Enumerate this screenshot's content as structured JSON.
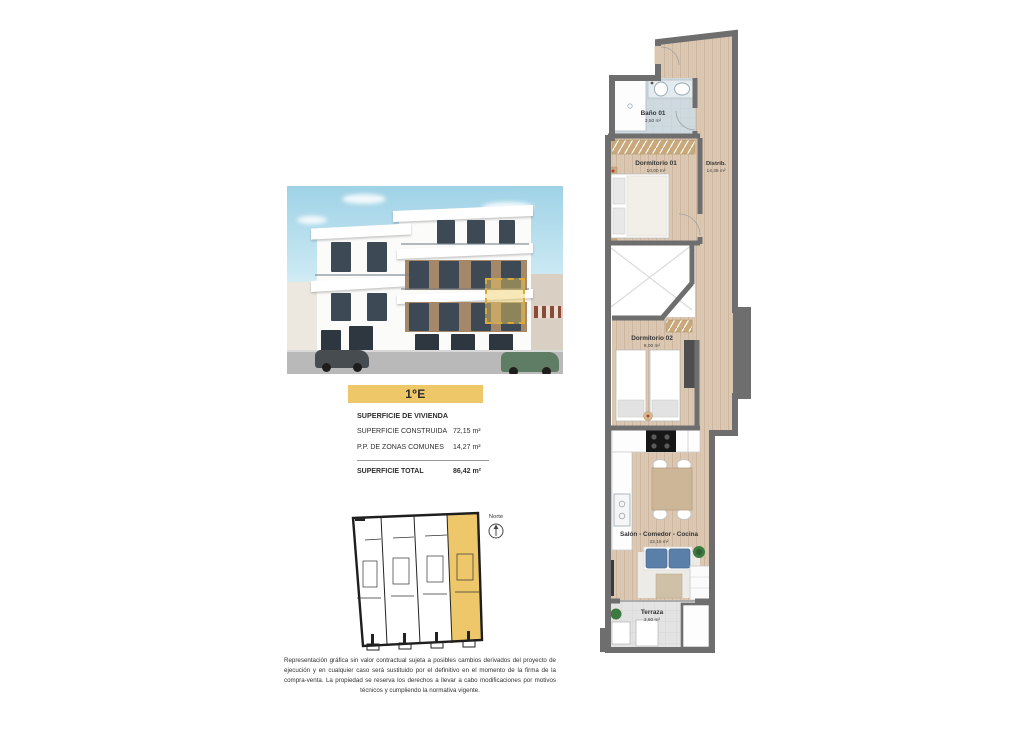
{
  "unit": {
    "label": "1ºE"
  },
  "surface": {
    "title": "SUPERFICIE DE VIVIENDA",
    "rows": [
      {
        "label": "SUPERFICIE CONSTRUIDA",
        "value": "72,15 m²"
      },
      {
        "label": "P.P. DE ZONAS COMUNES",
        "value": "14,27 m²"
      }
    ],
    "total_label": "SUPERFICIE TOTAL",
    "total_value": "86,42 m²"
  },
  "key_plan": {
    "north_label": "Norte"
  },
  "floor_plan": {
    "rooms": {
      "bano": {
        "name": "Baño 01",
        "area": "3,50 m²"
      },
      "dormitorio1": {
        "name": "Dormitorio 01",
        "area": "10,00 m²"
      },
      "distribuidor": {
        "name": "Distrib.",
        "area": "14,35 m²"
      },
      "dormitorio2": {
        "name": "Dormitorio 02",
        "area": "8,00 m²"
      },
      "salon": {
        "name": "Salón - Comedor - Cocina",
        "area": "22,15 m²"
      },
      "terraza": {
        "name": "Terraza",
        "area": "3,60 m²"
      }
    }
  },
  "disclaimer": "Representación gráfica sin valor contractual sujeta a posibles cambios derivados del proyecto de ejecución y en cualquier caso será sustituido por el definitivo en el momento de la firma de la compra-venta. La propiedad se reserva los derechos a llevar a cabo modificaciones por motivos técnicos y cumpliendo la normativa vigente.",
  "colors": {
    "accent_yellow": "#eec768",
    "wall_gray": "#6e6e6e",
    "wood_floor": "#dcc8b2",
    "bath_floor": "#cfdae0"
  }
}
